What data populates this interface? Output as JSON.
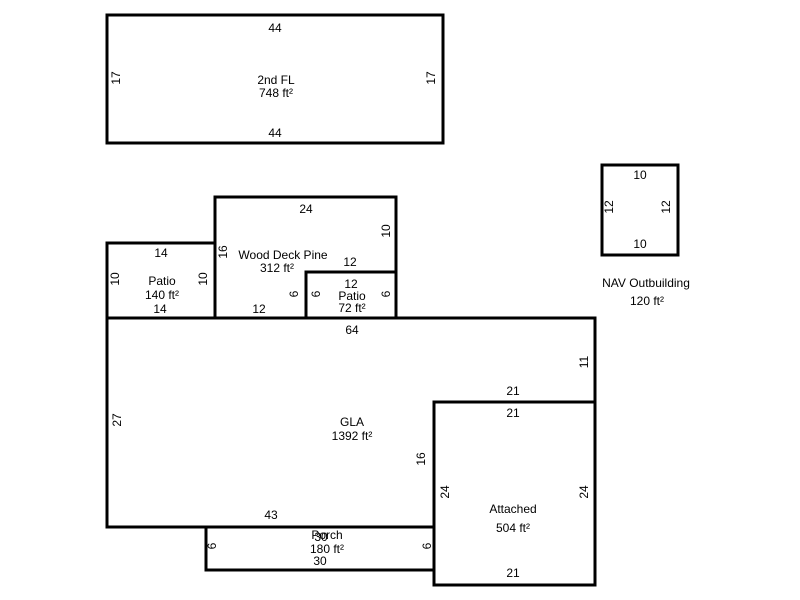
{
  "colors": {
    "background": "#ffffff",
    "line": "#000000",
    "text": "#000000"
  },
  "shapes": {
    "second_floor": {
      "label": "2nd FL",
      "area": "748 ft²",
      "dim_top": "44",
      "dim_bottom": "44",
      "dim_left": "17",
      "dim_right": "17"
    },
    "outbuilding": {
      "label": "NAV Outbuilding",
      "area": "120 ft²",
      "dim_top": "10",
      "dim_bottom": "10",
      "dim_left": "12",
      "dim_right": "12"
    },
    "wood_deck": {
      "label": "Wood Deck Pine",
      "area": "312 ft²",
      "dim_top": "24",
      "dim_left": "16",
      "dim_right": "10",
      "dim_step_top": "12",
      "dim_step_side": "6",
      "dim_bottom": "12"
    },
    "patio_large": {
      "label": "Patio",
      "area": "140 ft²",
      "dim_top": "14",
      "dim_bottom": "14",
      "dim_left": "10",
      "dim_right": "10"
    },
    "patio_small": {
      "label": "Patio",
      "area": "72 ft²",
      "dim_top": "12",
      "dim_left": "6",
      "dim_right": "6"
    },
    "gla": {
      "label": "GLA",
      "area": "1392 ft²",
      "dim_top": "64",
      "dim_left": "27",
      "dim_right": "11",
      "dim_notch_top": "21",
      "dim_notch_side": "16",
      "dim_bottom": "43"
    },
    "attached": {
      "label": "Attached",
      "area": "504 ft²",
      "dim_top": "21",
      "dim_bottom": "21",
      "dim_left": "24",
      "dim_right": "24"
    },
    "porch": {
      "label": "Porch",
      "area": "180 ft²",
      "dim_top": "30",
      "dim_bottom": "30",
      "dim_left": "6",
      "dim_right": "6"
    }
  }
}
